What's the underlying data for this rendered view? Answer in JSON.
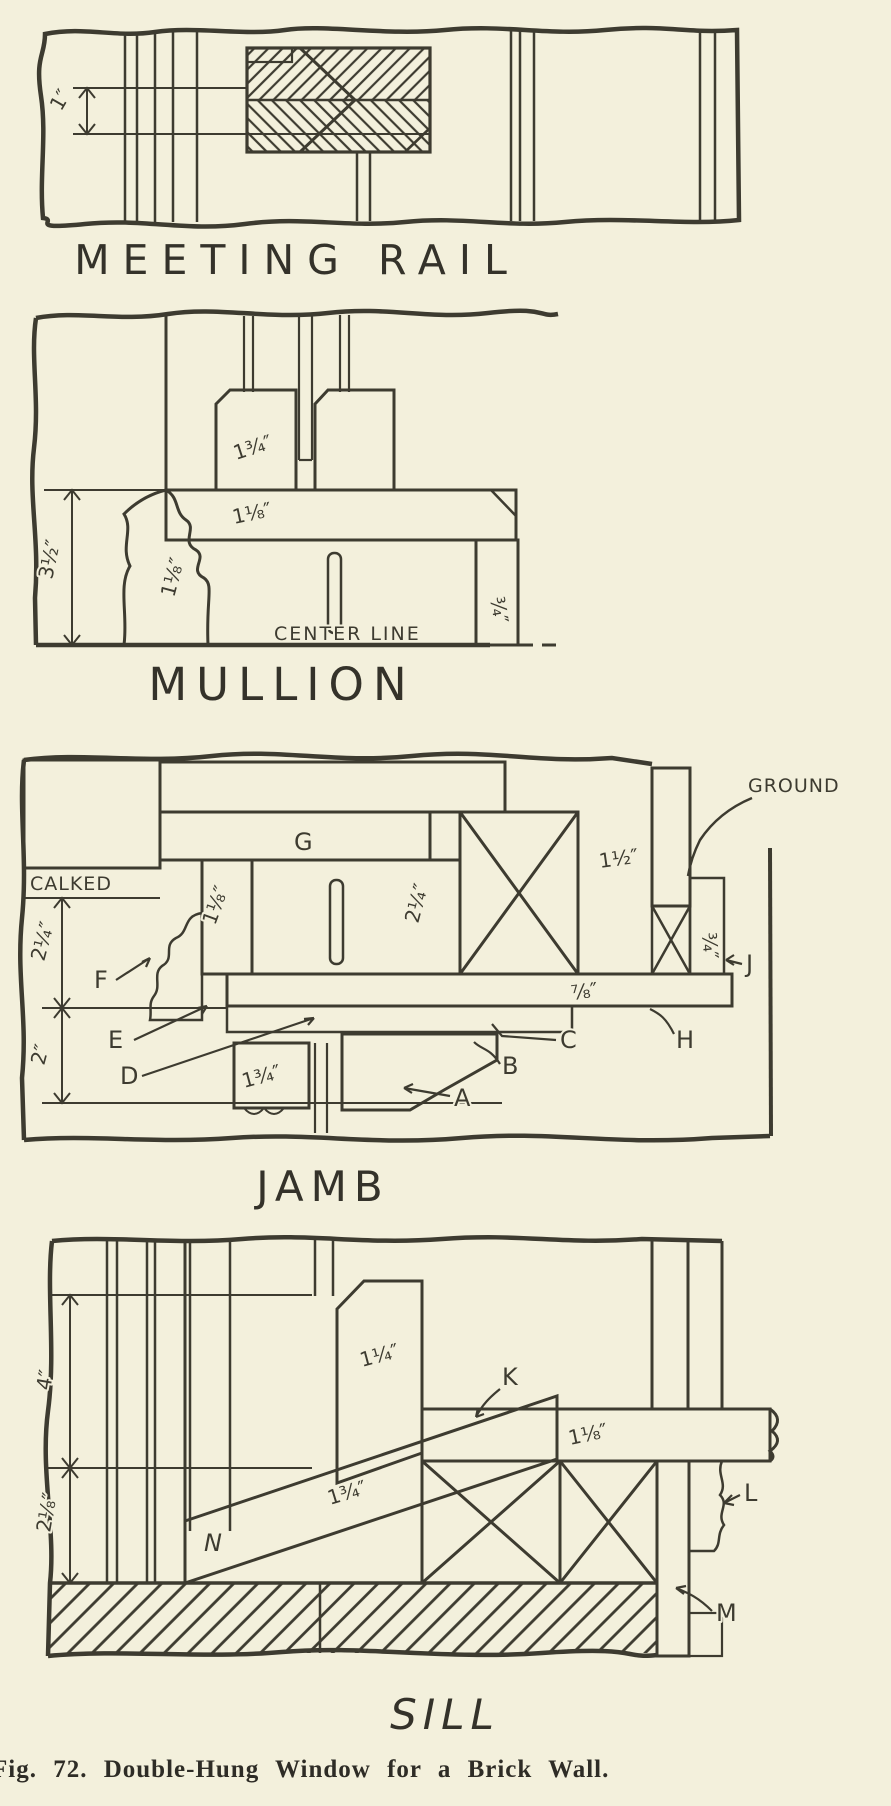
{
  "figure": {
    "caption": "Fig. 72. Double-Hung Window for a Brick Wall.",
    "background_color": "#f3f0dc",
    "ink_color": "#3d3b30"
  },
  "meeting_rail": {
    "title": "MEETING RAIL",
    "dims": {
      "rail_thickness": "1″"
    }
  },
  "mullion": {
    "title": "MULLION",
    "center_line_label": "CENTER LINE",
    "dims": {
      "sash_stile": "1¾″",
      "head_jamb": "1⅛″",
      "mullion_depth": "3½″",
      "mullion_casing": "1⅛″",
      "outside_casing": "¾″"
    }
  },
  "jamb": {
    "title": "JAMB",
    "notes": {
      "calked": "CALKED",
      "ground": "GROUND"
    },
    "labels": {
      "a": "A",
      "b": "B",
      "c": "C",
      "d": "D",
      "e": "E",
      "f": "F",
      "g": "G",
      "h": "H",
      "j": "J"
    },
    "dims": {
      "brick_reveal": "2¼″",
      "backing": "2″",
      "pulley_stile": "1⅛″",
      "sash_opening": "2¼″",
      "stud": "1½″",
      "sash_stile": "1¾″",
      "blind_stop": "⅞″",
      "ground_strip": "¾″"
    }
  },
  "sill": {
    "title": "SILL",
    "labels": {
      "k": "K",
      "l": "L",
      "m": "M",
      "n": "N"
    },
    "dims": {
      "brick_courses": "4″",
      "sill_height": "2⅛″",
      "bottom_rail": "1¼″",
      "sill_thickness": "1¾″",
      "stool": "1⅛″"
    }
  }
}
